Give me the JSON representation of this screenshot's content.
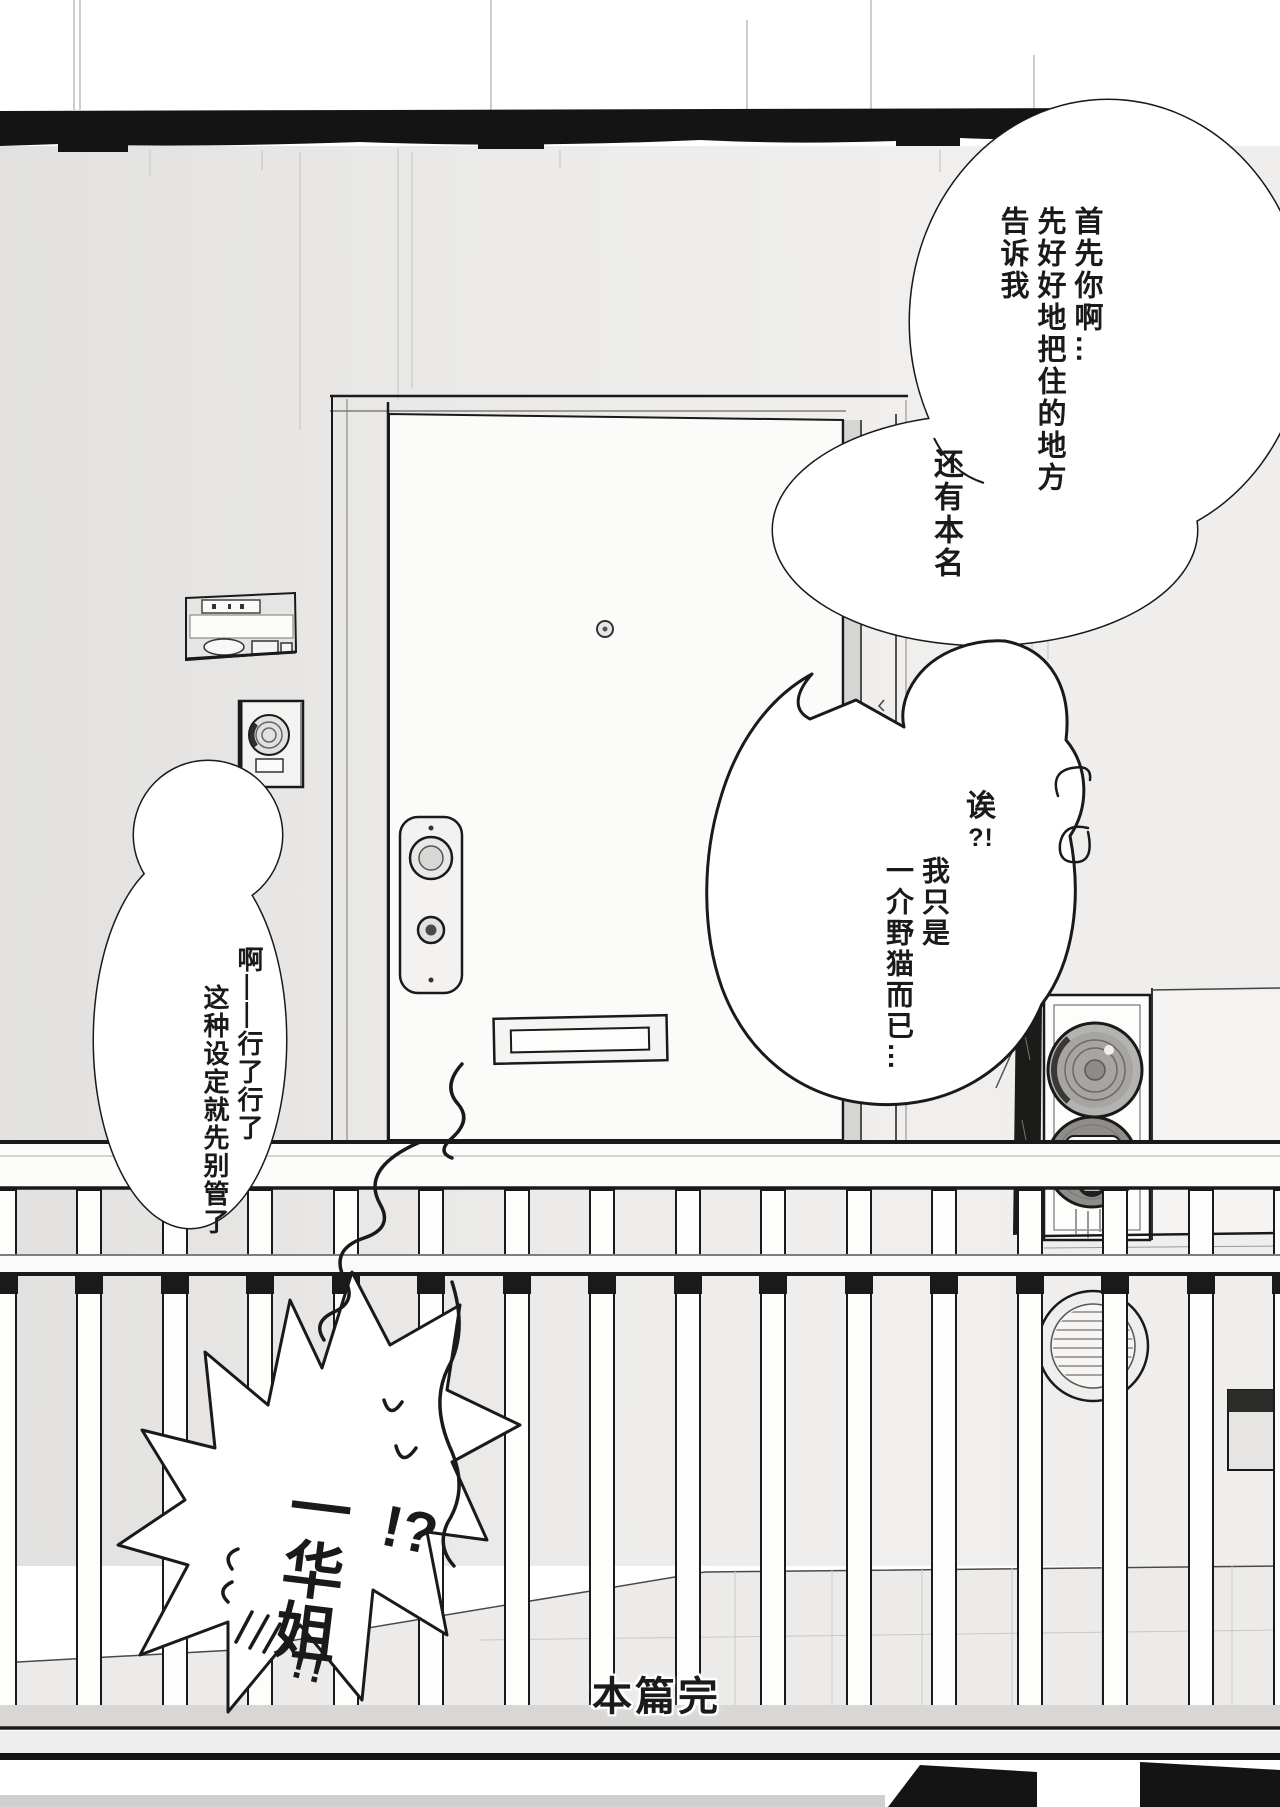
{
  "bubbles": {
    "top_right": {
      "lines": [
        "首先你啊…",
        "先好好地把住的地方",
        "告诉我"
      ]
    },
    "attach": {
      "text": "还有本名"
    },
    "middle": {
      "exclaim_char": "诶",
      "exclaim_marks": "?!",
      "lines": [
        "我只是",
        "一介野猫而已…"
      ]
    },
    "left": {
      "lines": [
        "啊——行了行了",
        "这种设定就先别管了"
      ]
    },
    "shout": {
      "name": "一华姐",
      "interrobang": "!?",
      "bang": "!!"
    }
  },
  "caption": {
    "end": "本篇完"
  },
  "colors": {
    "ink": "#1a1a1a",
    "paper": "#ffffff",
    "wall": "#e9e8e6",
    "walldark": "#dcdbd9",
    "door": "#fbfbf9",
    "floor": "#ecebe9",
    "curb": "#d8d7d5",
    "metal": "#b5b3b1",
    "bell": "#8f8c89",
    "band": "#141414"
  }
}
